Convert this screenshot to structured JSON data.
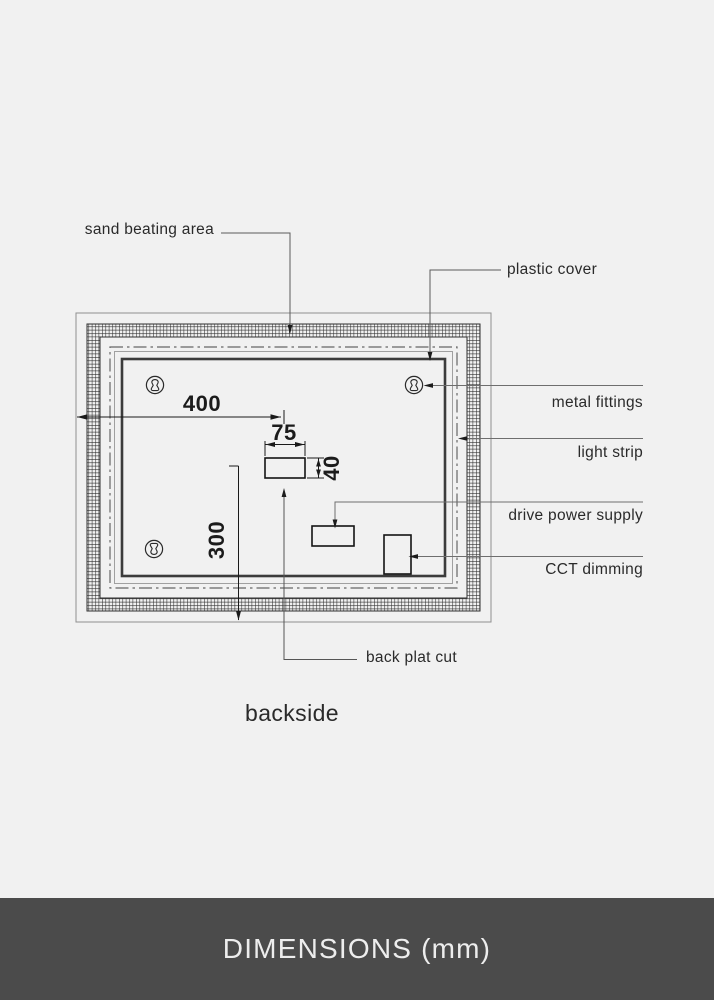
{
  "diagram": {
    "callouts": {
      "sand_beating_area": "sand beating area",
      "plastic_cover": "plastic cover",
      "metal_fittings": "metal fittings",
      "light_strip": "light strip",
      "drive_power_supply": "drive power supply",
      "cct_dimming": "CCT dimming",
      "back_plat_cut": "back plat cut"
    },
    "dimensions": {
      "overall_width": "400",
      "cut_width": "75",
      "cut_height": "40",
      "overall_height": "300"
    },
    "view_label": "backside"
  },
  "footer": {
    "title": "DIMENSIONS (mm)"
  },
  "colors": {
    "background": "#f1f1f1",
    "footer_background": "#4b4b4b",
    "footer_text": "#ededed",
    "line_dark": "#1c1c1c",
    "panel_line": "#3b3b3b",
    "light_line": "#8f8f8f",
    "leader_line": "#6e6e6e"
  }
}
